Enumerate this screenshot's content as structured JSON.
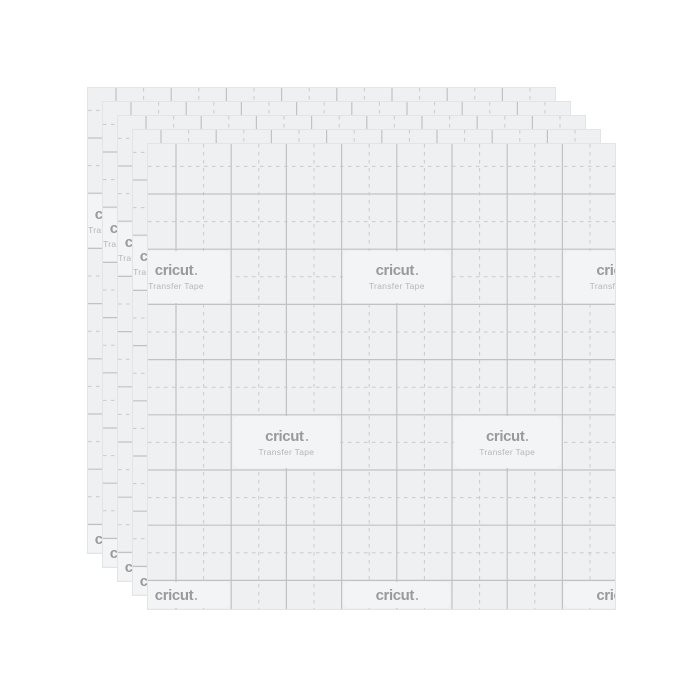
{
  "product": {
    "brand": "cricut",
    "name": "Transfer Tape",
    "sheet_count": 5
  },
  "colors": {
    "background": "#ffffff",
    "sheet": "#eff0f1",
    "sheet_edge": "#e3e4e6",
    "grid_solid": "#c0c2c5",
    "grid_dashed": "#c8cacc",
    "label_box": "#f3f4f5",
    "brand_text": "#999a9d",
    "subtitle_text": "#b5b6b9"
  }
}
